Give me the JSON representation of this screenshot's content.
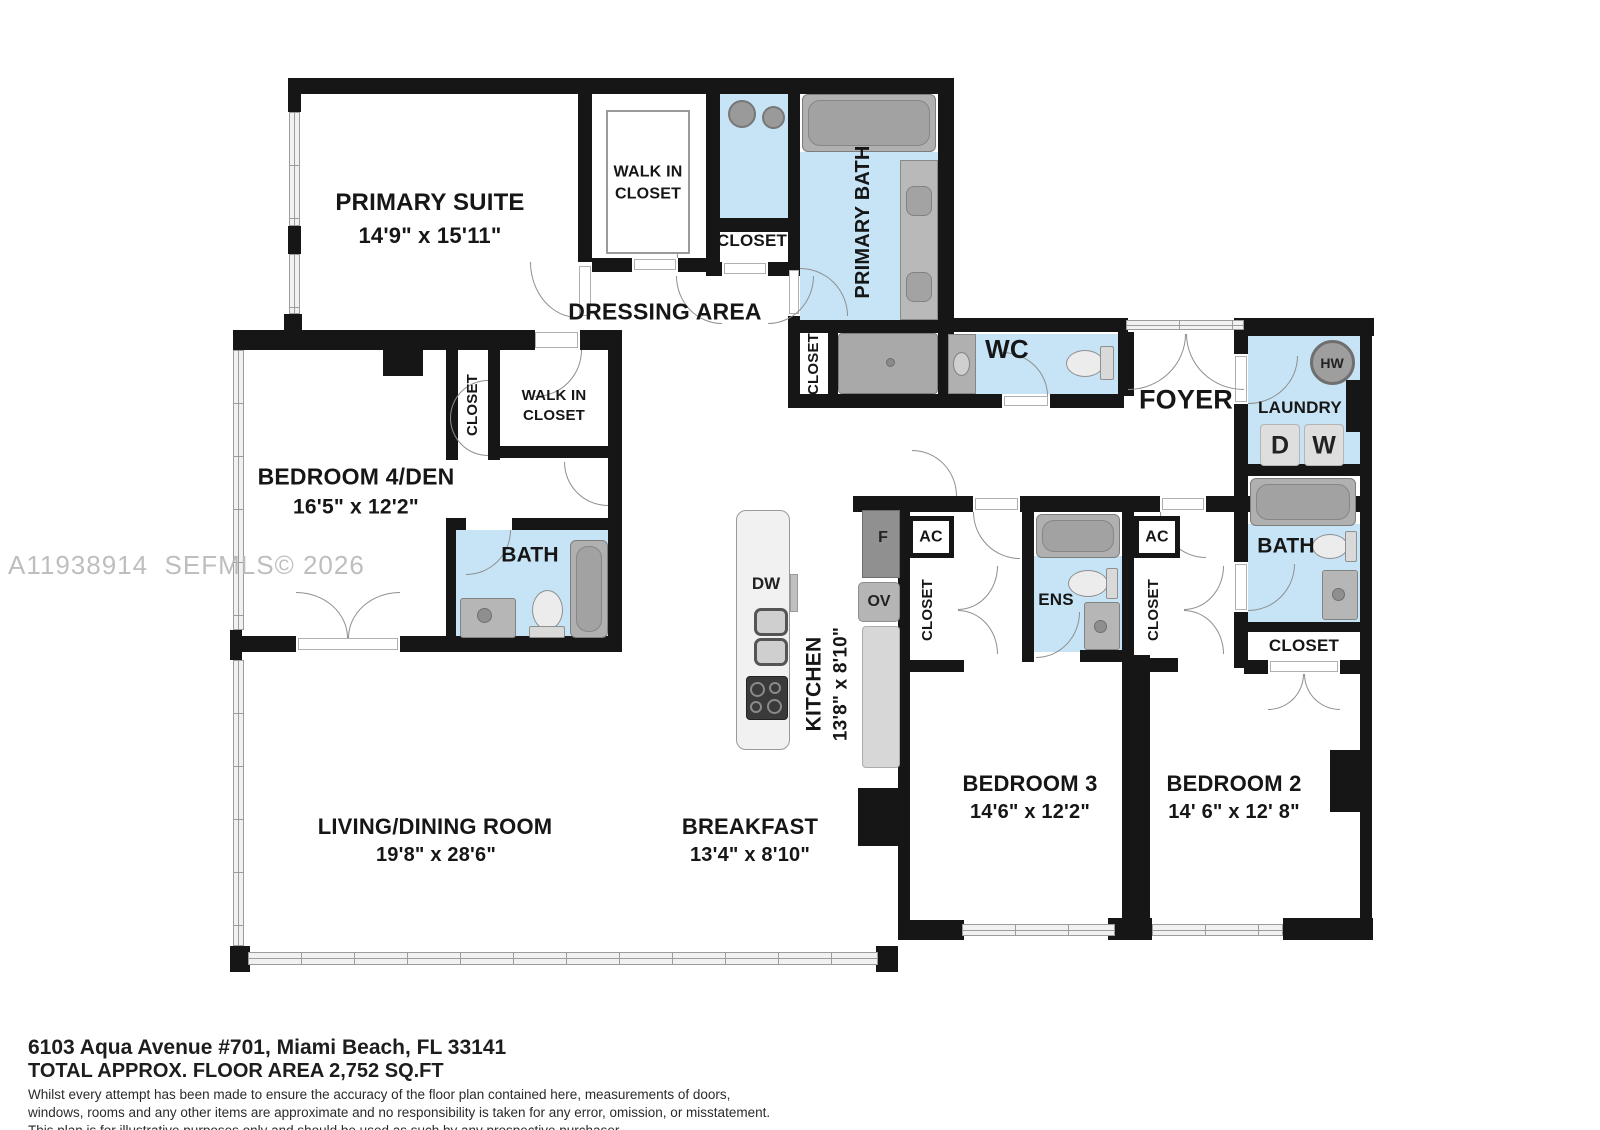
{
  "plan": {
    "watermark": "A11938914  SEFMLS© 2026",
    "rooms": {
      "primary_suite": {
        "name": "PRIMARY SUITE",
        "dims": "14'9\" x 15'11\""
      },
      "walk_in_closet_primary": {
        "line1": "WALK IN",
        "line2": "CLOSET"
      },
      "closet_primary": "CLOSET",
      "primary_bath": "PRIMARY BATH",
      "dressing_area": "DRESSING AREA",
      "hall_closet": "CLOSET",
      "wc": "WC",
      "foyer": "FOYER",
      "laundry": {
        "name": "LAUNDRY",
        "dryer": "D",
        "washer": "W",
        "water_heater": "HW"
      },
      "bath2": {
        "name": "BATH",
        "closet": "CLOSET"
      },
      "bedroom2": {
        "name": "BEDROOM 2",
        "dims": "14' 6\" x 12' 8\"",
        "ac": "AC",
        "closet": "CLOSET"
      },
      "bedroom3": {
        "name": "BEDROOM 3",
        "dims": "14'6\" x 12'2\"",
        "ac": "AC",
        "closet": "CLOSET",
        "ensuite": "ENS"
      },
      "bedroom4": {
        "name": "BEDROOM 4/DEN",
        "dims": "16'5\" x 12'2\"",
        "closet": "CLOSET"
      },
      "walk_in_closet_bed4": {
        "line1": "WALK IN",
        "line2": "CLOSET"
      },
      "bath4": {
        "name": "BATH"
      },
      "kitchen": {
        "name": "KITCHEN",
        "dims": "13'8\" x 8'10\"",
        "dishwasher": "DW",
        "fridge": "F",
        "oven": "OV"
      },
      "living": {
        "name": "LIVING/DINING ROOM",
        "dims": "19'8\" x 28'6\""
      },
      "breakfast": {
        "name": "BREAKFAST",
        "dims": "13'4\" x 8'10\""
      }
    }
  },
  "footer": {
    "address": "6103 Aqua Avenue #701, Miami Beach, FL 33141",
    "area": "TOTAL APPROX. FLOOR AREA 2,752 SQ.FT",
    "disclaimer1": "Whilst every attempt has been made to ensure the accuracy of the floor plan contained here, measurements of doors,",
    "disclaimer2": "windows, rooms and any other items are approximate and no responsibility is taken for any error, omission, or misstatement.",
    "disclaimer3": "This plan is for illustrative purposes only and should be used as such by any prospective purchaser."
  },
  "colors": {
    "wall": "#161616",
    "wet_room_blue": "#c6e4f6",
    "fixture_gray": "#b0b0b0",
    "watermark_gray": "#b7b7b7"
  }
}
